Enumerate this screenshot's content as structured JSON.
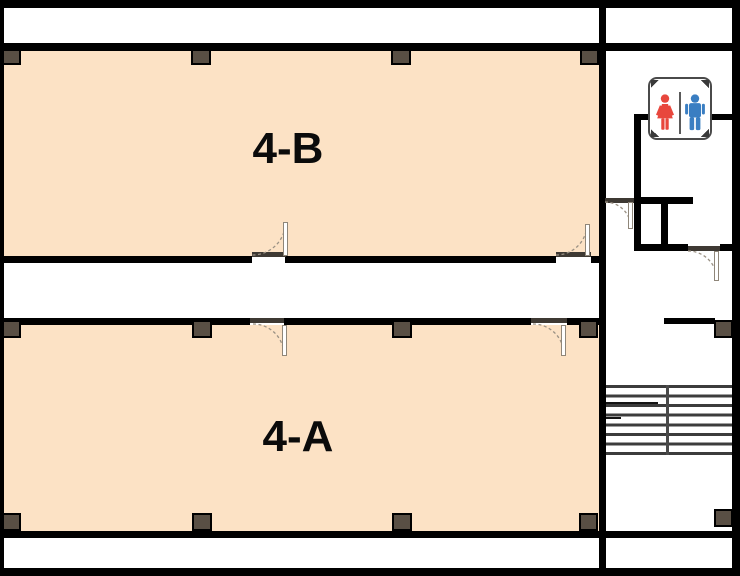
{
  "rooms": [
    {
      "label": "4-B"
    },
    {
      "label": "4-A"
    }
  ],
  "restroom_sign": {
    "female_icon": "female-figure-icon",
    "male_icon": "male-figure-icon"
  },
  "stairs": {
    "visible_treads": 7,
    "tread_lines": 8
  },
  "colors": {
    "room_fill": "#fce2c5",
    "wall": "#000000",
    "column_fill": "#594f44",
    "stair_line": "#3c3c3c",
    "door_swing_arc": "#9a9184",
    "door_threshold": "#3e3933",
    "restroom_female": "#e8473d",
    "restroom_male": "#3a7ec2",
    "sign_border": "#4a4a4a"
  }
}
